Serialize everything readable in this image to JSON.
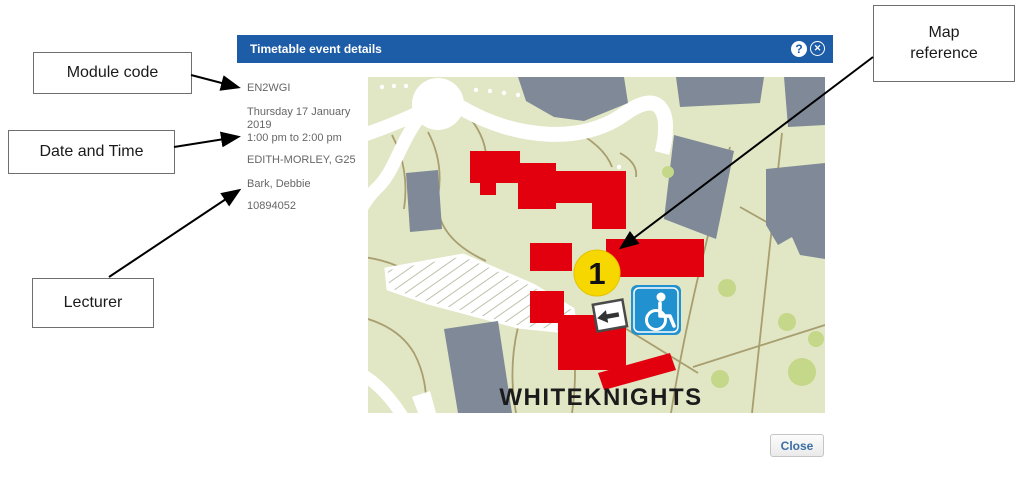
{
  "annotations": {
    "module_code_label": "Module code",
    "date_time_label": "Date and Time",
    "lecturer_label": "Lecturer",
    "map_reference_label": "Map reference"
  },
  "dialog": {
    "title": "Timetable event details",
    "help_glyph": "?",
    "close_glyph": "✕",
    "close_button_label": "Close",
    "event": {
      "module_code": "EN2WGI",
      "date_line1": "Thursday 17 January",
      "date_line2": "2019",
      "time": "1:00 pm to 2:00 pm",
      "location": "EDITH-MORLEY, G25",
      "lecturer": "Bark, Debbie",
      "reference_number": "10894052"
    }
  },
  "map": {
    "campus_label": "WHITEKNIGHTS",
    "marker_number": "1"
  },
  "colors": {
    "header_blue": "#1d5ca7",
    "building_red": "#e2000f",
    "building_gray": "#7f8997",
    "map_background": "#e1e6c4",
    "path_olive": "#a89e6f",
    "tree_green": "#c5d789",
    "marker_yellow": "#f7d700",
    "accessibility_blue": "#2191d0",
    "close_button_text": "#3a6ea5"
  }
}
